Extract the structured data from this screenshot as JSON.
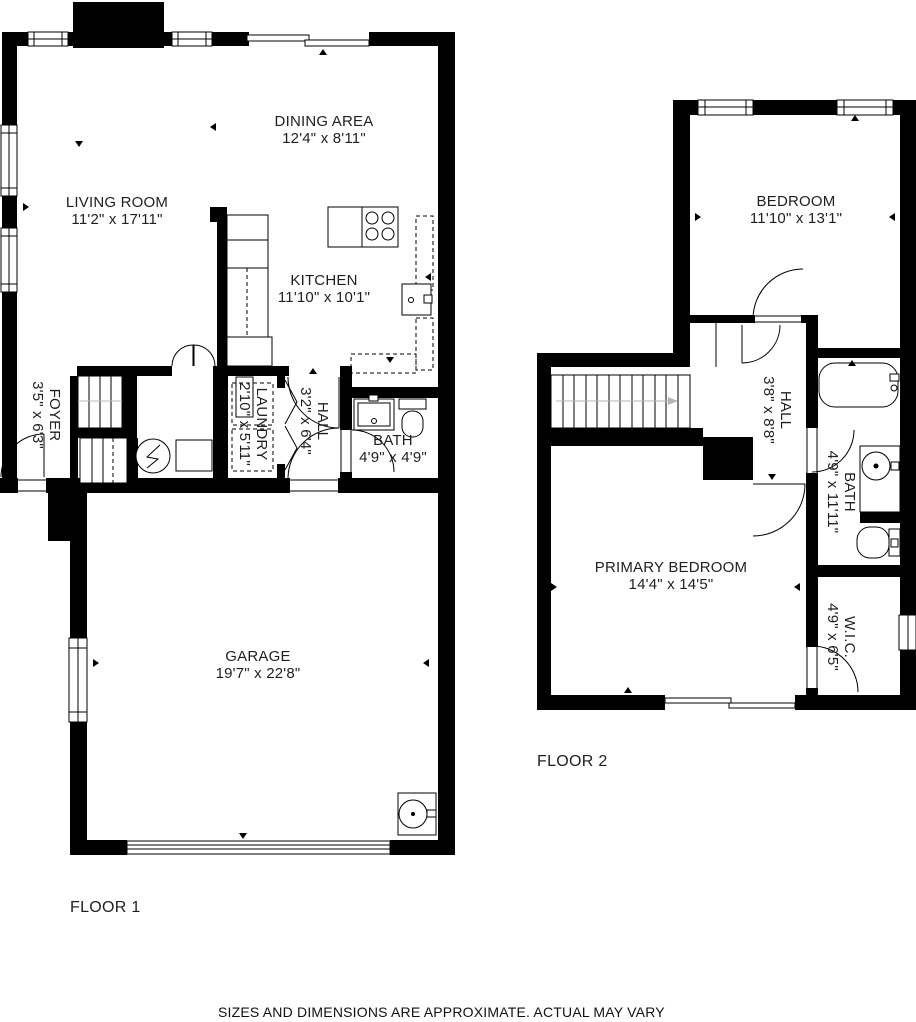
{
  "floors": [
    {
      "label": "FLOOR 1",
      "rooms": [
        {
          "name": "LIVING ROOM",
          "dims": "11'2\" x 17'11\""
        },
        {
          "name": "DINING AREA",
          "dims": "12'4\" x 8'11\""
        },
        {
          "name": "KITCHEN",
          "dims": "11'10\" x 10'1\""
        },
        {
          "name": "FOYER",
          "dims": "3'5\" x 6'3\""
        },
        {
          "name": "LAUNDRY",
          "dims": "2'10\" x 5'11\""
        },
        {
          "name": "HALL",
          "dims": "3'2\" x 6'4\""
        },
        {
          "name": "BATH",
          "dims": "4'9\" x 4'9\""
        },
        {
          "name": "GARAGE",
          "dims": "19'7\" x 22'8\""
        }
      ]
    },
    {
      "label": "FLOOR 2",
      "rooms": [
        {
          "name": "BEDROOM",
          "dims": "11'10\" x 13'1\""
        },
        {
          "name": "HALL",
          "dims": "3'8\" x 8'8\""
        },
        {
          "name": "BATH",
          "dims": "4'9\" x 11'11\""
        },
        {
          "name": "PRIMARY BEDROOM",
          "dims": "14'4\" x 14'5\""
        },
        {
          "name": "W.I.C.",
          "dims": "4'9\" x 6'5\""
        }
      ]
    }
  ],
  "disclaimer": "SIZES AND DIMENSIONS ARE APPROXIMATE. ACTUAL MAY VARY",
  "colors": {
    "wall": "#000000",
    "background": "#ffffff",
    "text": "#1f1f1f"
  }
}
